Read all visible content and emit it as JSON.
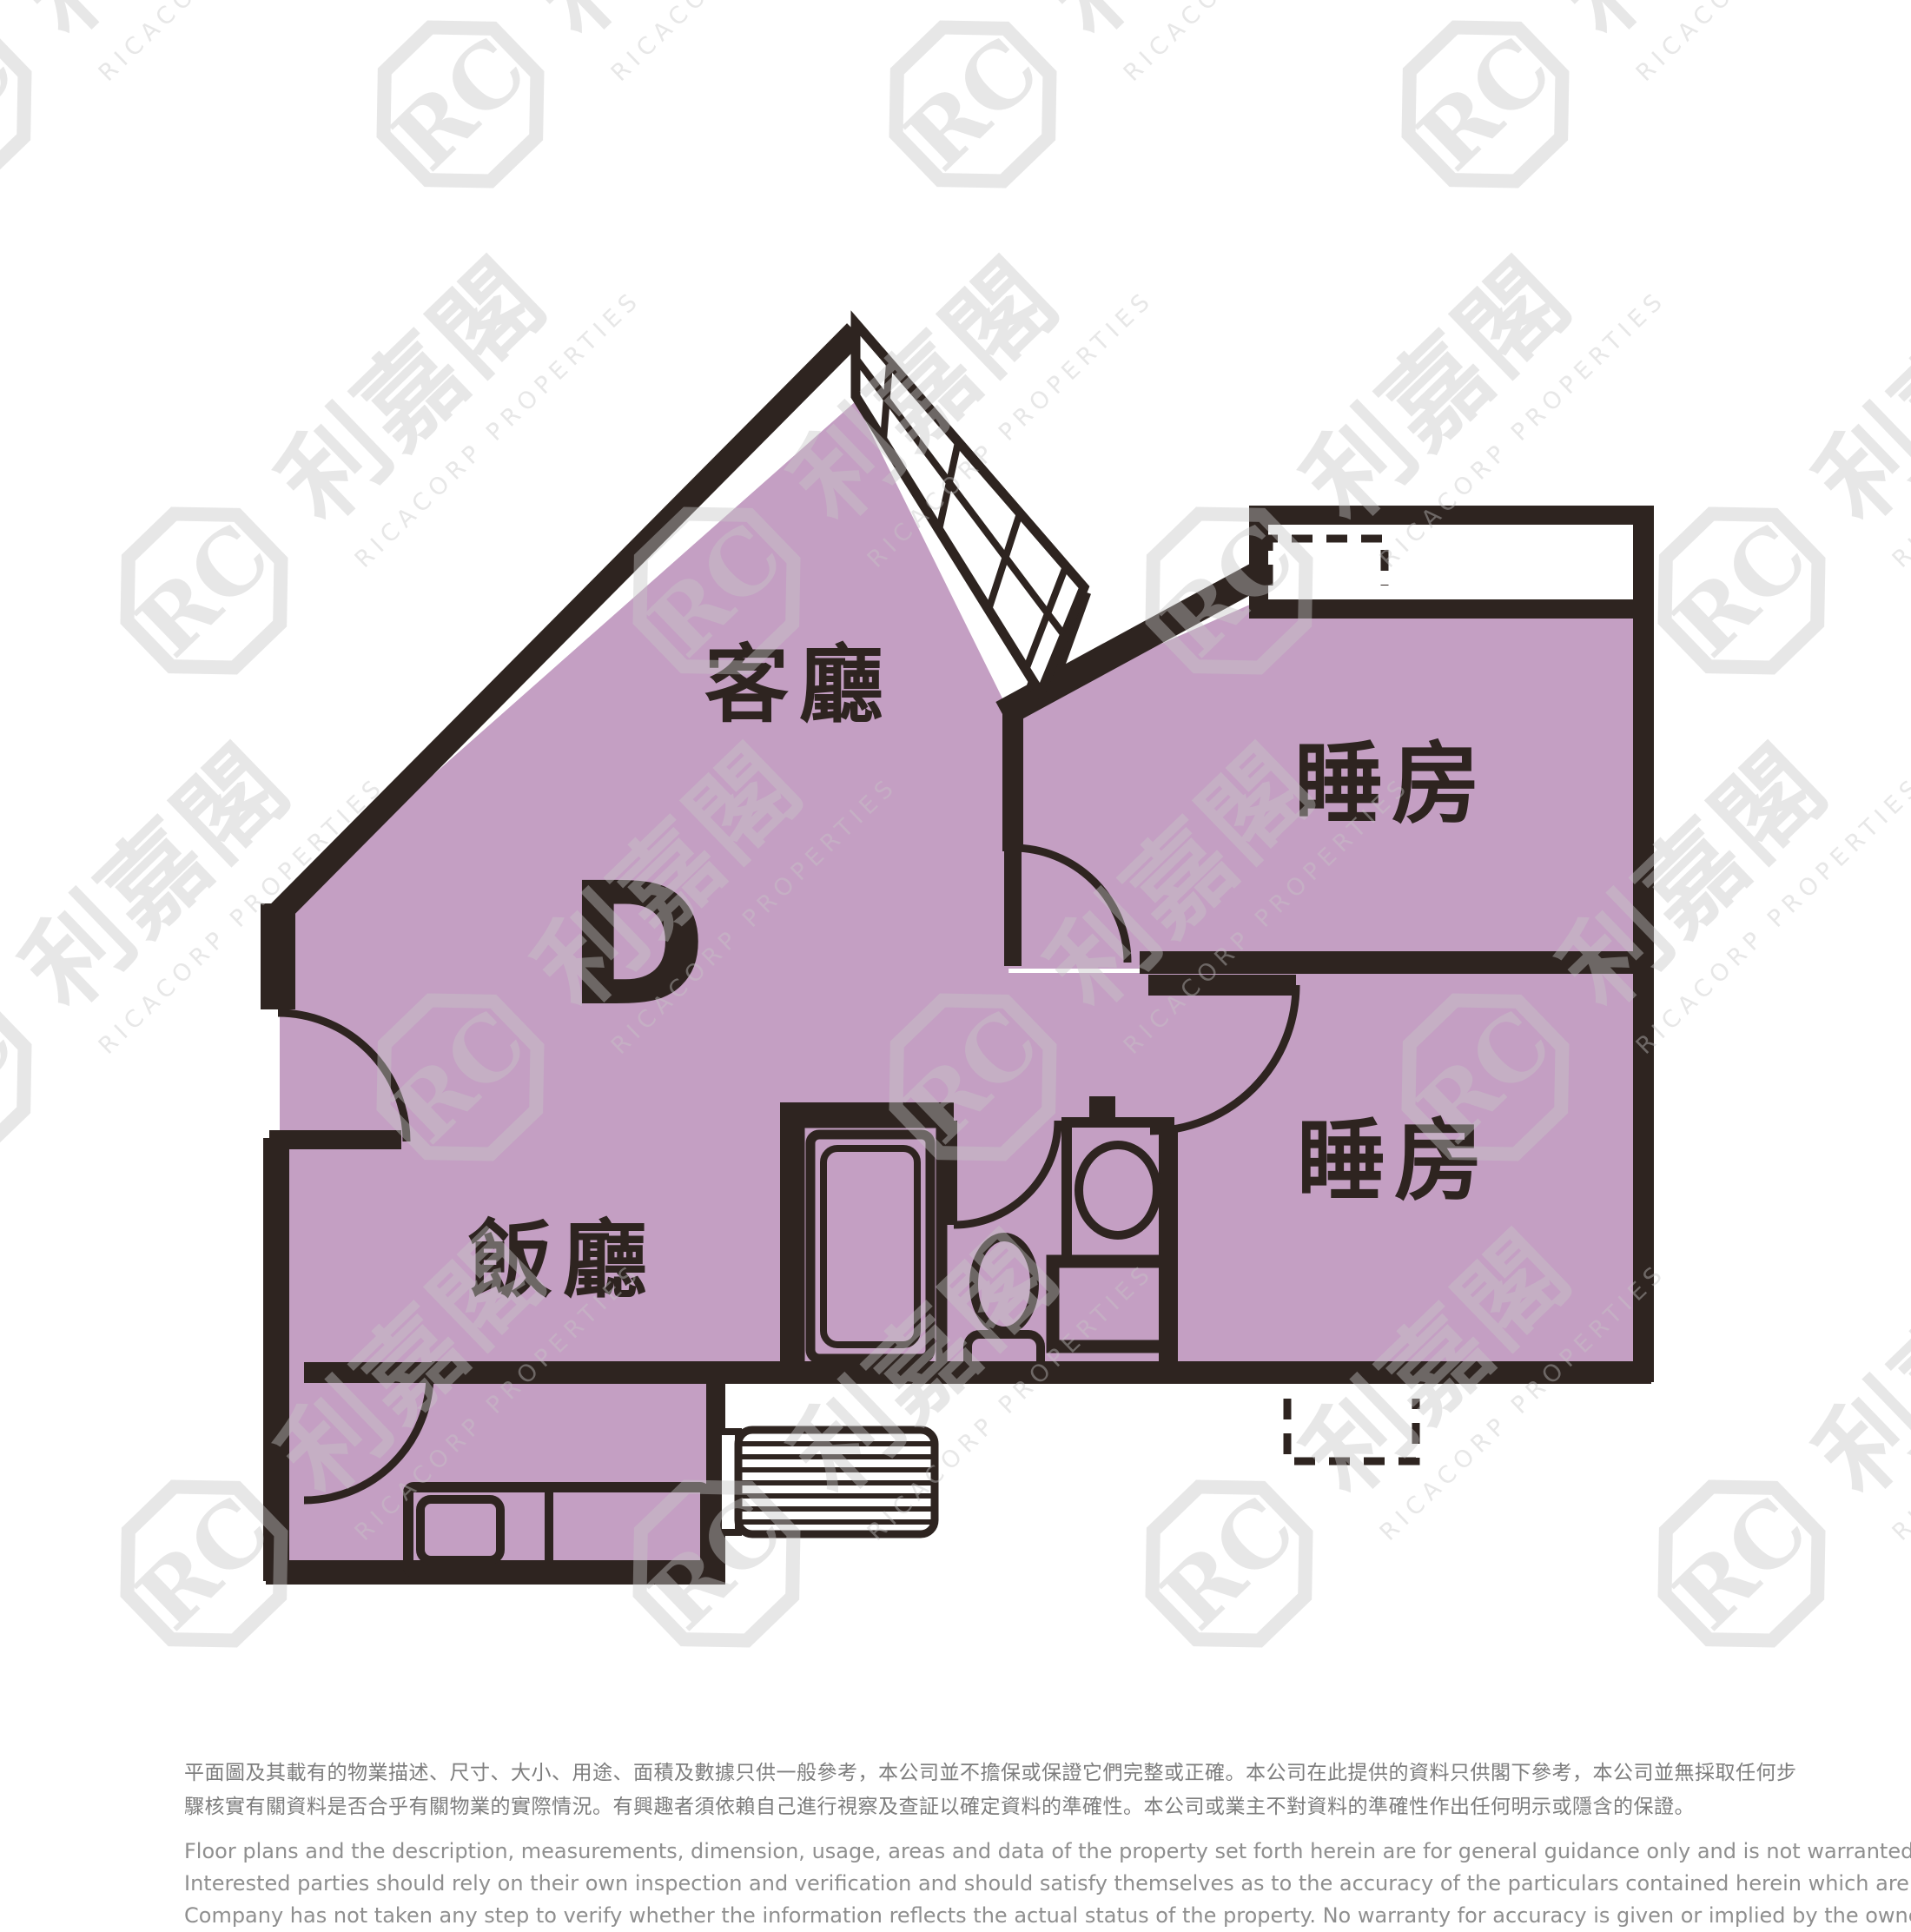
{
  "colors": {
    "floor_fill": "#c49fc3",
    "wall": "#2e2420",
    "watermark": "#c6c6c6",
    "disclaimer_zh": "#7d7d7d",
    "disclaimer_en": "#8f8f8f"
  },
  "unit_label": "D",
  "rooms": {
    "living": "客廳",
    "dining": "飯廳",
    "bedroom1": "睡房",
    "bedroom2": "睡房"
  },
  "watermark": {
    "monogram": "RC",
    "brand": "利嘉閣",
    "brand_en": "RICACORP PROPERTIES"
  },
  "disclaimer": {
    "zh": [
      "平面圖及其載有的物業描述、尺寸、大小、用途、面積及數據只供一般參考，本公司並不擔保或保證它們完整或正確。本公司在此提供的資料只供閣下參考，本公司並無採取任何步",
      "驟核實有關資料是否合乎有關物業的實際情況。有興趣者須依賴自己進行視察及查証以確定資料的準確性。本公司或業主不對資料的準確性作出任何明示或隱含的保證。"
    ],
    "en": [
      "Floor plans and the description, measurements, dimension, usage, areas and data of the property set forth herein are for general guidance only and is not warranted or guaranteed to be complete or correct.",
      "Interested parties should rely on their own inspection and verification and should satisfy themselves as to the accuracy of the particulars contained herein which are provided by us for information only.  Our",
      "Company has not taken any step to verify whether the information reflects the actual status of the property.  No warranty for accuracy is given or implied by the owners or us."
    ]
  }
}
